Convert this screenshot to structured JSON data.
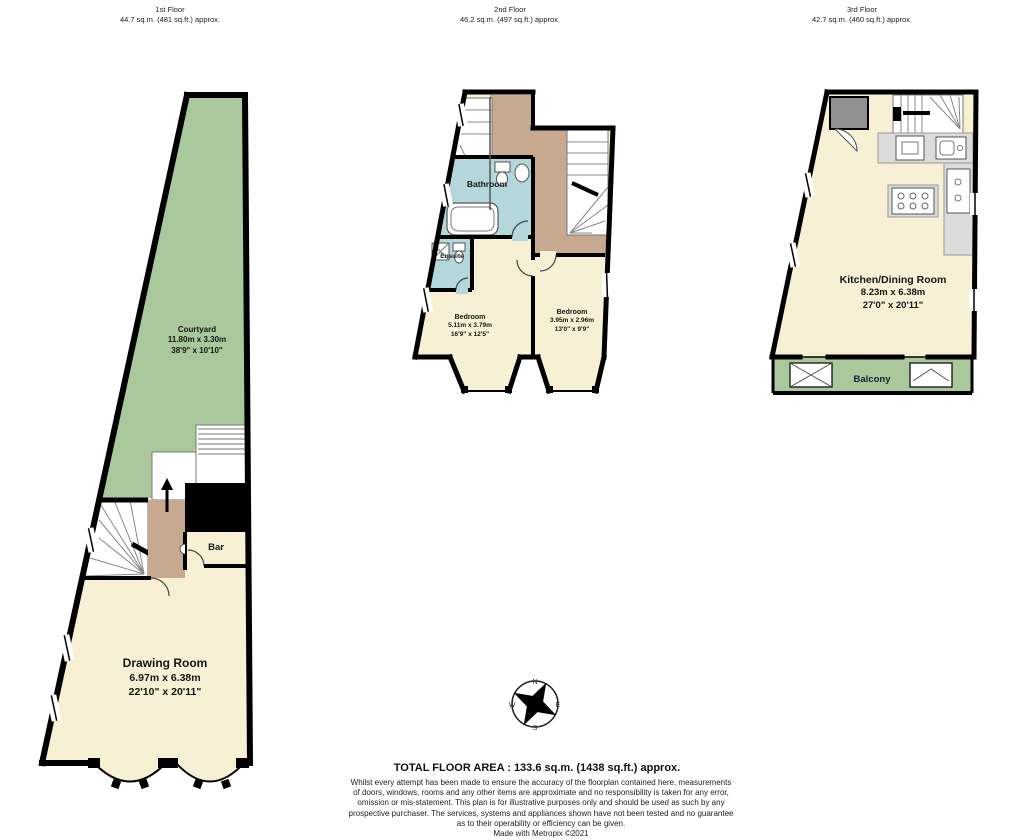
{
  "floors": [
    {
      "title": "1st Floor",
      "area": "44.7 sq.m. (481 sq.ft.) approx.",
      "rooms": {
        "courtyard": {
          "name": "Courtyard",
          "metric": "11.80m x 3.30m",
          "imperial": "38'9\" x 10'10\""
        },
        "bar": {
          "name": "Bar"
        },
        "drawing_room": {
          "name": "Drawing Room",
          "metric": "6.97m x 6.38m",
          "imperial": "22'10\" x 20'11\""
        }
      }
    },
    {
      "title": "2nd Floor",
      "area": "46.2 sq.m. (497 sq.ft.) approx.",
      "rooms": {
        "bathroom": {
          "name": "Bathroom"
        },
        "ensuite": {
          "name": "Ensuite"
        },
        "bedroom_left": {
          "name": "Bedroom",
          "metric": "5.11m x 3.79m",
          "imperial": "16'9\" x 12'5\""
        },
        "bedroom_right": {
          "name": "Bedroom",
          "metric": "3.95m x 2.96m",
          "imperial": "13'0\" x 9'9\""
        }
      }
    },
    {
      "title": "3rd Floor",
      "area": "42.7 sq.m. (460 sq.ft.) approx.",
      "rooms": {
        "kitchen": {
          "name": "Kitchen/Dining Room",
          "metric": "8.23m x 6.38m",
          "imperial": "27'0\" x 20'11\""
        },
        "balcony": {
          "name": "Balcony"
        }
      }
    }
  ],
  "compass": {
    "n": "N",
    "e": "E",
    "s": "S",
    "w": "W"
  },
  "footer": {
    "total": "TOTAL FLOOR AREA : 133.6 sq.m. (1438 sq.ft.) approx.",
    "disclaimer_lines": [
      "Whilst every attempt has been made to ensure the accuracy of the floorplan contained here, measurements",
      "of doors, windows, rooms and any other items are approximate and no responsibility is taken for any error,",
      "omission or mis-statement. This plan is for illustrative purposes only and should be used as such by any",
      "prospective purchaser. The services, systems and appliances shown have not been tested and no guarantee",
      "as to their operability or efficiency can be given."
    ],
    "credit": "Made with Metropix ©2021"
  },
  "colors": {
    "wall": "#000000",
    "room_cream": "#F7F0D5",
    "courtyard_green": "#A9C89B",
    "bathroom_blue": "#B4D7DB",
    "landing_brown": "#C7A98F",
    "counter_grey": "#DCDCDC"
  }
}
